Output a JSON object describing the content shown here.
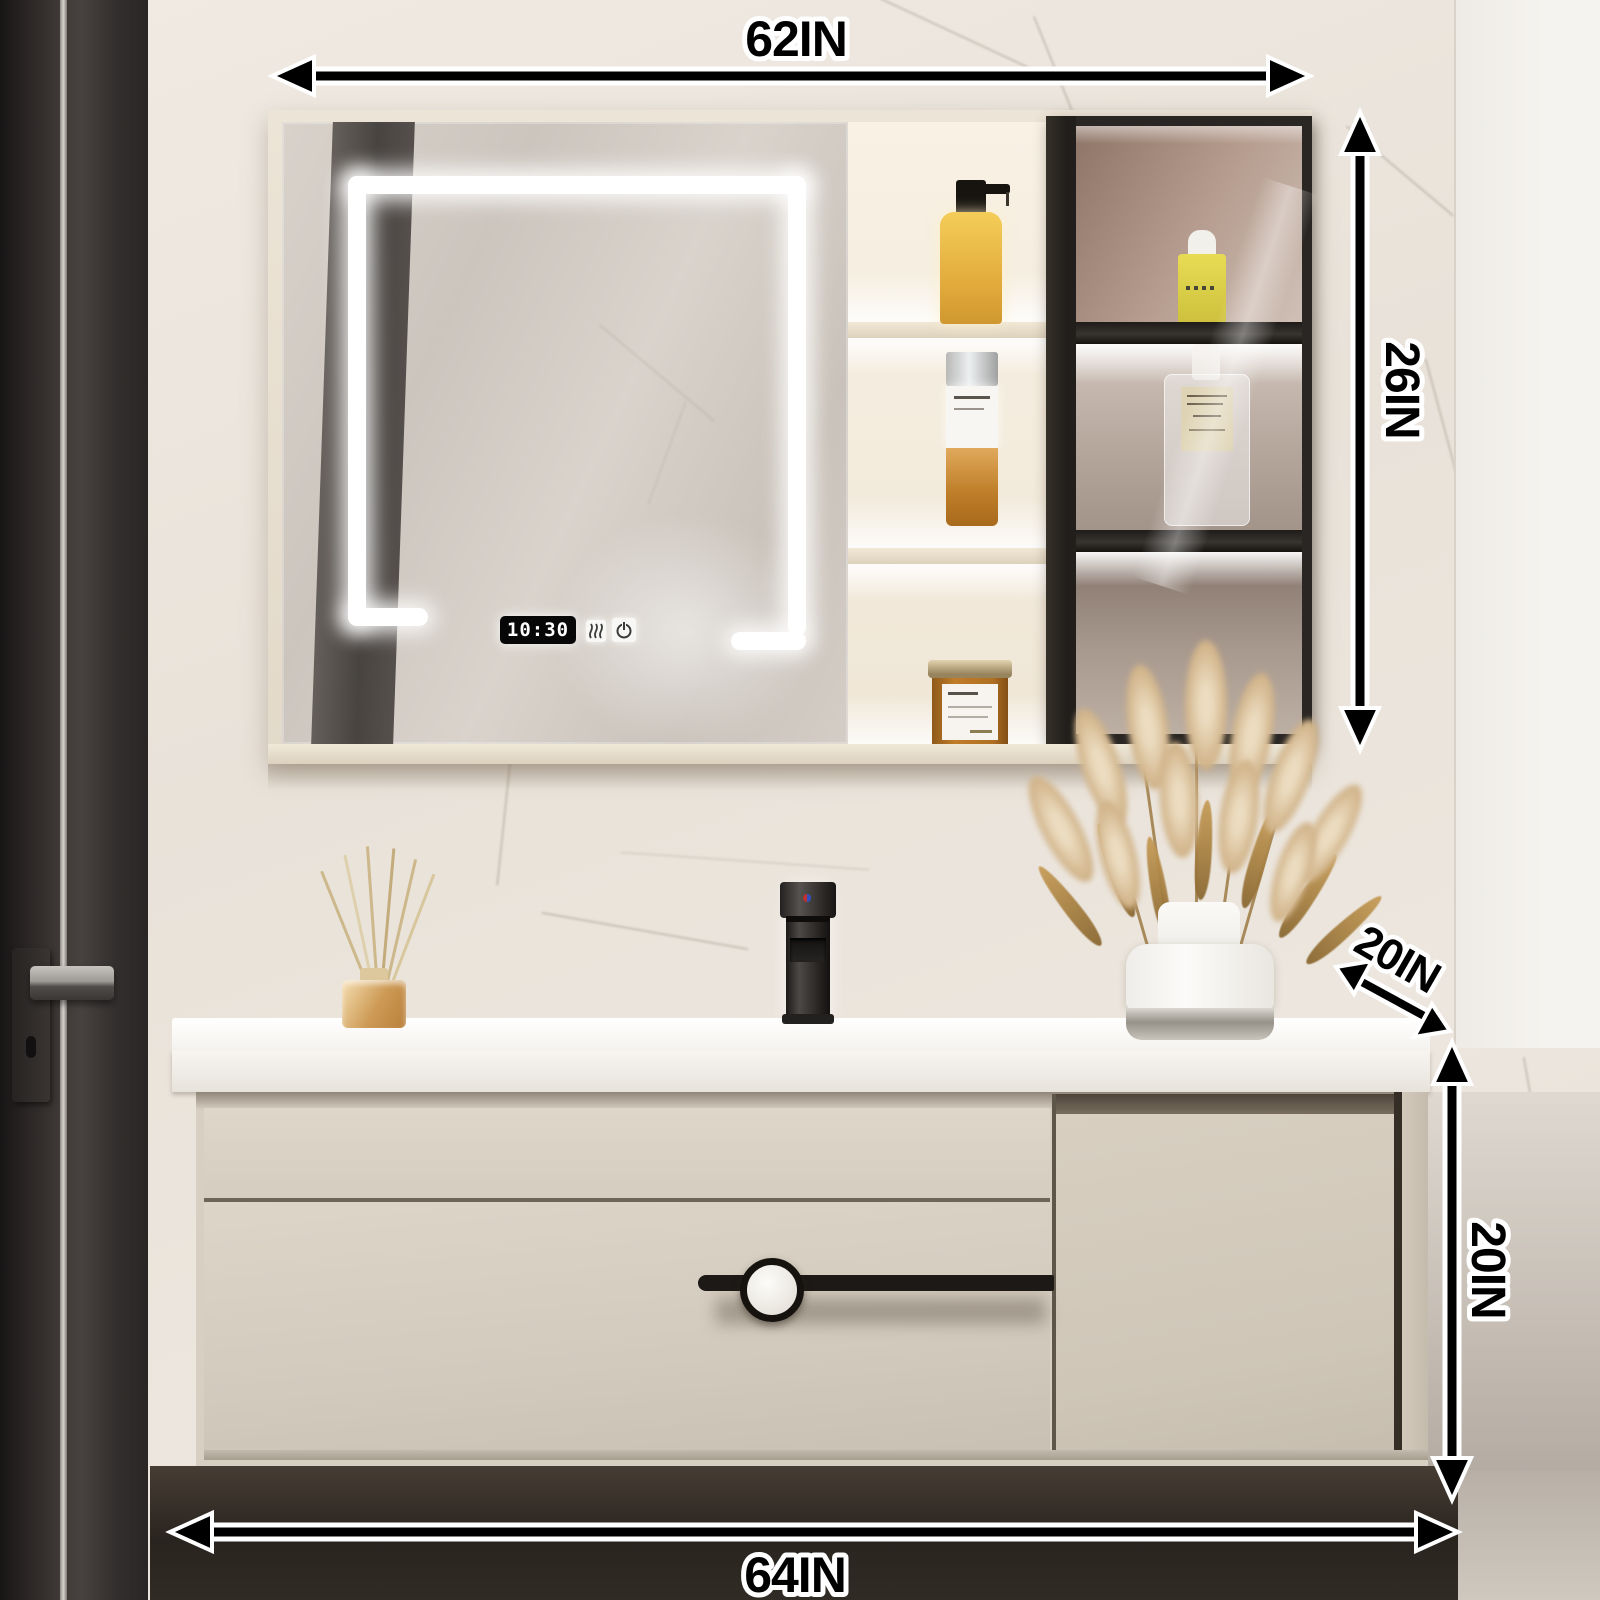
{
  "annotations": {
    "top_width": {
      "label": "62IN"
    },
    "cabinet_height": {
      "label": "26IN"
    },
    "counter_depth": {
      "label": "20IN"
    },
    "vanity_height": {
      "label": "20IN"
    },
    "bottom_width": {
      "label": "64IN"
    }
  },
  "mirror_display": {
    "time": "10:30",
    "icons": [
      {
        "name": "defogger-icon"
      },
      {
        "name": "power-icon"
      }
    ]
  },
  "colors": {
    "annotation_fill": "#000000",
    "annotation_outline": "#ffffff",
    "cabinet_cream": "#e8e0d2",
    "vanity_body": "#d7cfc2",
    "counter_white": "#fafaf8",
    "glass_frame_black": "#2a2623",
    "led_white": "#ffffff",
    "bottle_yellow": "#eebc41",
    "amber_jar": "#b0701f"
  }
}
